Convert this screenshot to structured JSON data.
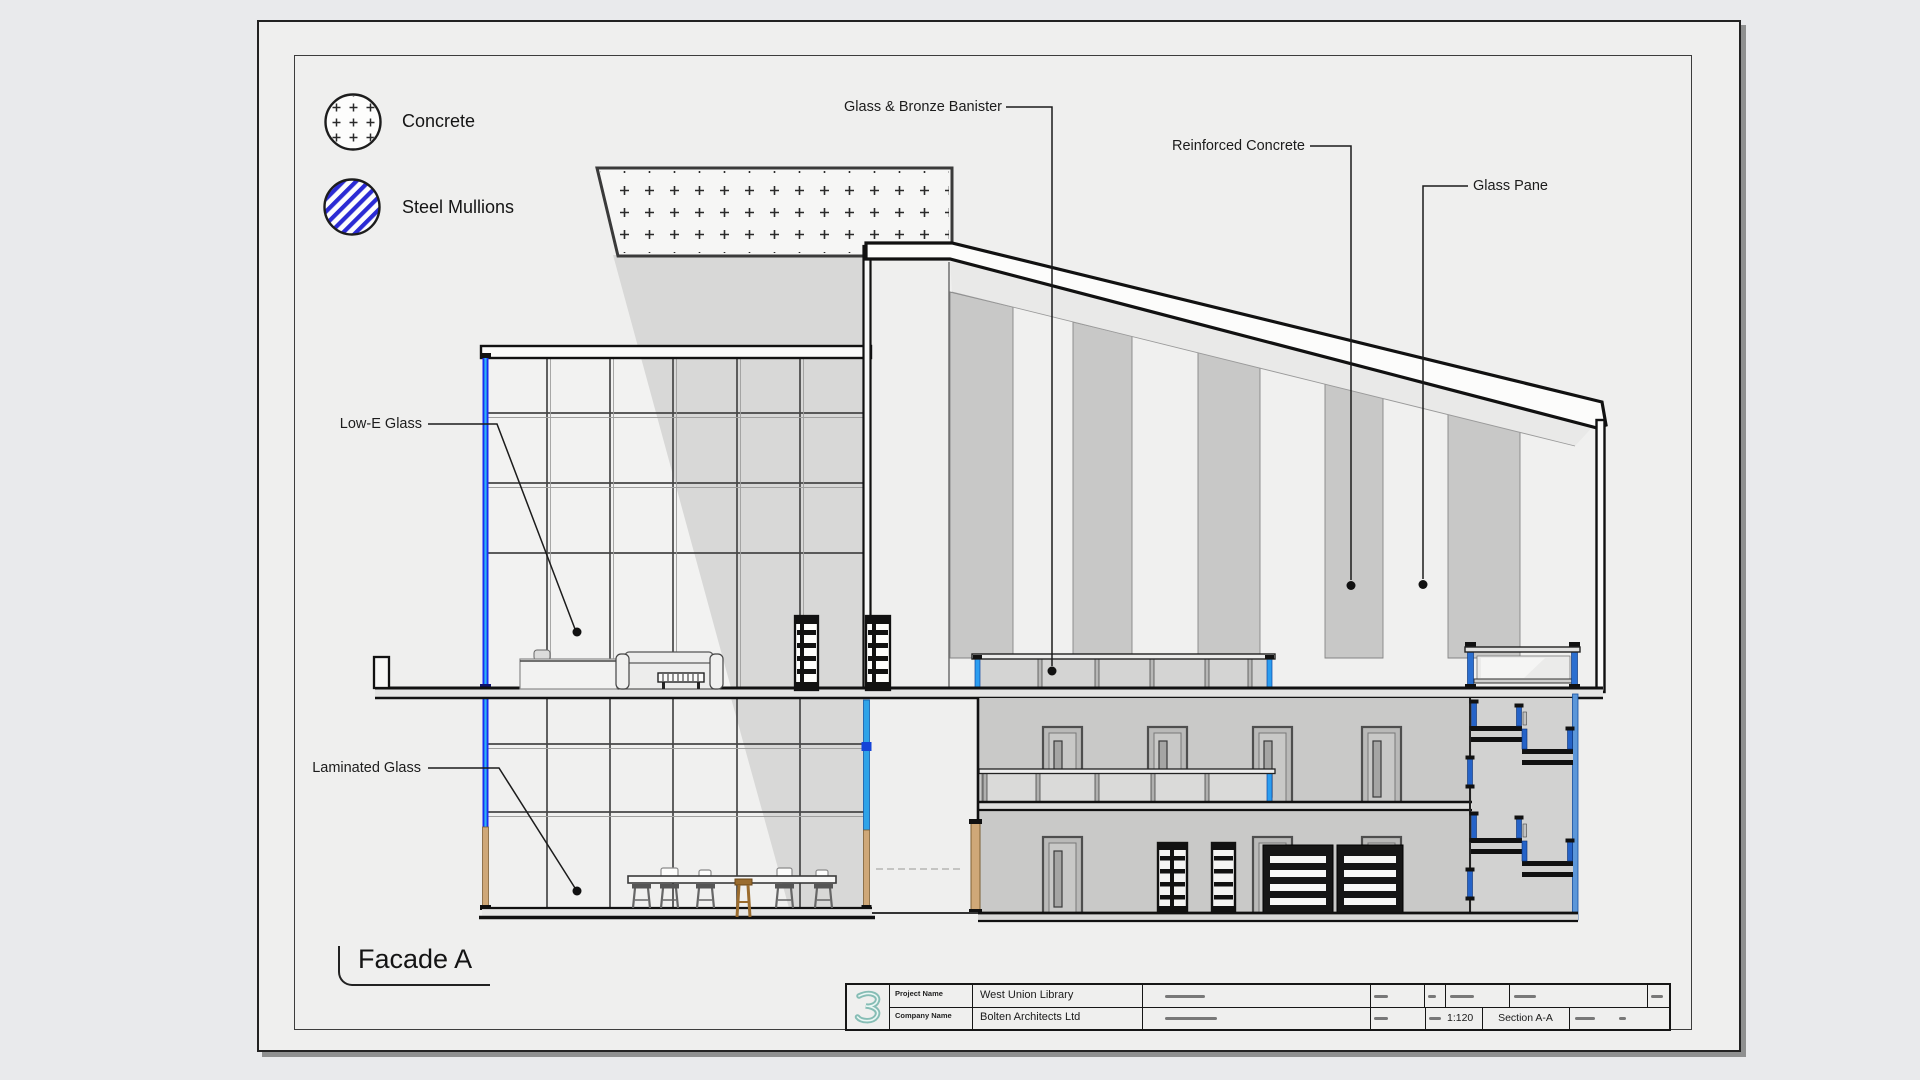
{
  "drawing_title": "Facade A",
  "legend": {
    "items": [
      {
        "icon": "concrete-hatch-swatch",
        "label": "Concrete"
      },
      {
        "icon": "steel-mullions-hatch-swatch",
        "label": "Steel Mullions"
      }
    ]
  },
  "callouts": [
    {
      "id": "glass-bronze-banister",
      "label": "Glass & Bronze Banister"
    },
    {
      "id": "reinforced-concrete",
      "label": "Reinforced Concrete"
    },
    {
      "id": "glass-pane",
      "label": "Glass Pane"
    },
    {
      "id": "low-e-glass",
      "label": "Low-E Glass"
    },
    {
      "id": "laminated-glass",
      "label": "Laminated Glass"
    }
  ],
  "title_block": {
    "project_name_label": "Project Name",
    "project_name": "West Union Library",
    "company_name_label": "Company Name",
    "company_name": "Bolten Architects Ltd",
    "scale": "1:120",
    "drawing_name": "Section A-A"
  },
  "colors": {
    "steel_mullion_blue": "#1b2cf0",
    "mullion_core_cyan": "#2db5f5",
    "legend_hatch_blue": "#2b2bd4",
    "stair_post_blue": "#2563c8",
    "banister_post_blue": "#2b9df0",
    "edge_glass_blue": "#5c97d9",
    "timber_tan": "#cfa878",
    "logo_teal": "#86bdb5"
  }
}
